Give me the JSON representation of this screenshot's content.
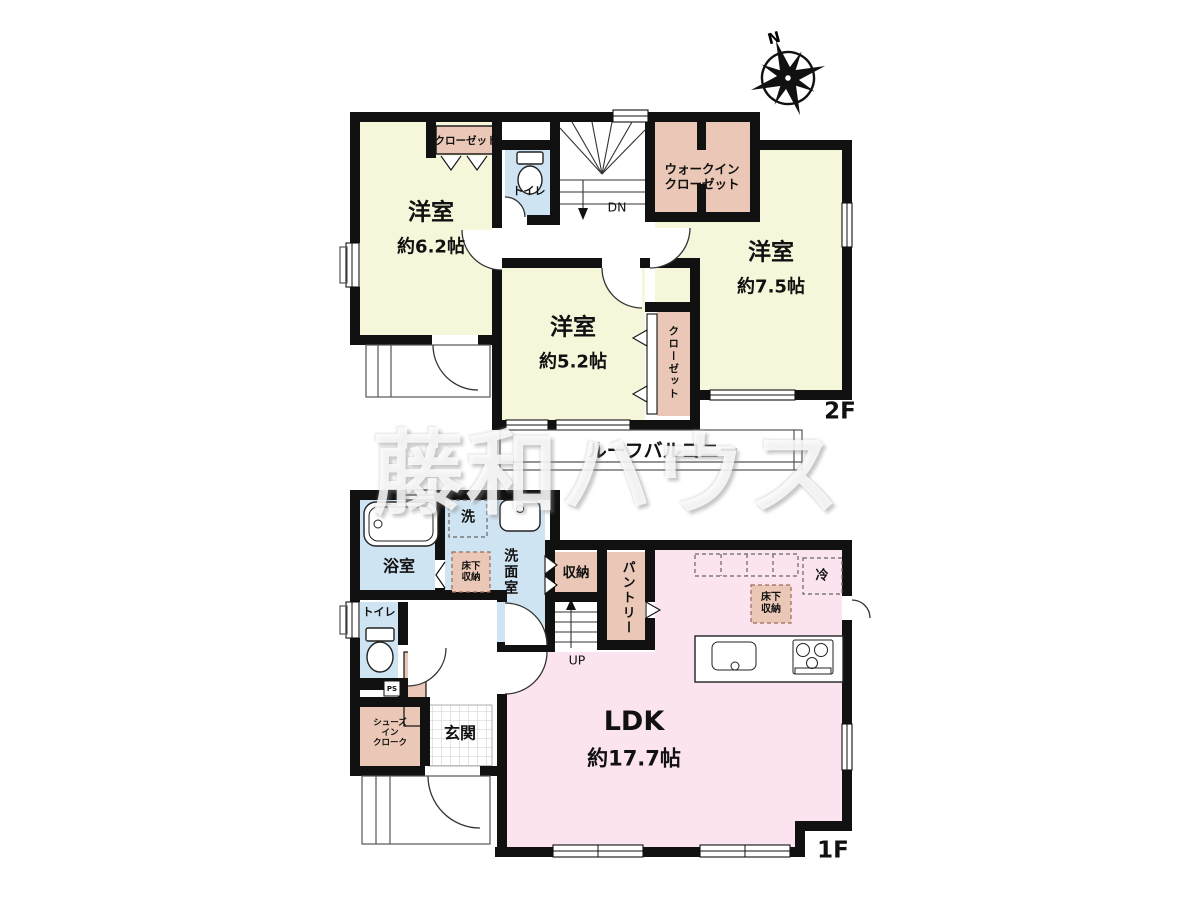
{
  "watermark": "藤和ハウス",
  "compass": {
    "north": "N"
  },
  "colors": {
    "wall": "#111111",
    "room_cream": "#f6f6da",
    "closet_pink": "#eac7b6",
    "wet_blue": "#cfe4f2",
    "ldk_pink": "#fbe4ef"
  },
  "floor2": {
    "floor_label": "2F",
    "room_6_2": {
      "name": "洋室",
      "size": "約6.2帖"
    },
    "room_7_5": {
      "name": "洋室",
      "size": "約7.5帖"
    },
    "room_5_2": {
      "name": "洋室",
      "size": "約5.2帖"
    },
    "toilet": "トイレ",
    "closet_top": "クローゼット",
    "closet_side": "クローゼット",
    "walk_in_closet": {
      "line1": "ウォークイン",
      "line2": "クローゼット"
    },
    "stairs_down": "DN",
    "roof_balcony": "ルーフバルコニー"
  },
  "floor1": {
    "floor_label": "1F",
    "ldk": {
      "name": "LDK",
      "size": "約17.7帖"
    },
    "bathroom": "浴室",
    "washer": "洗",
    "washroom": "洗面室",
    "underfloor_storage_wash": {
      "line1": "床下",
      "line2": "収納"
    },
    "underfloor_storage_kitchen": {
      "line1": "床下",
      "line2": "収納"
    },
    "storage": "収納",
    "pantry": "パントリー",
    "refrigerator": "冷",
    "toilet": "トイレ",
    "pipe_space": "PS",
    "shoes_in_closet": {
      "line1": "シューズ",
      "line2": "イン",
      "line3": "クローク"
    },
    "entrance": "玄関",
    "stairs_up": "UP"
  }
}
